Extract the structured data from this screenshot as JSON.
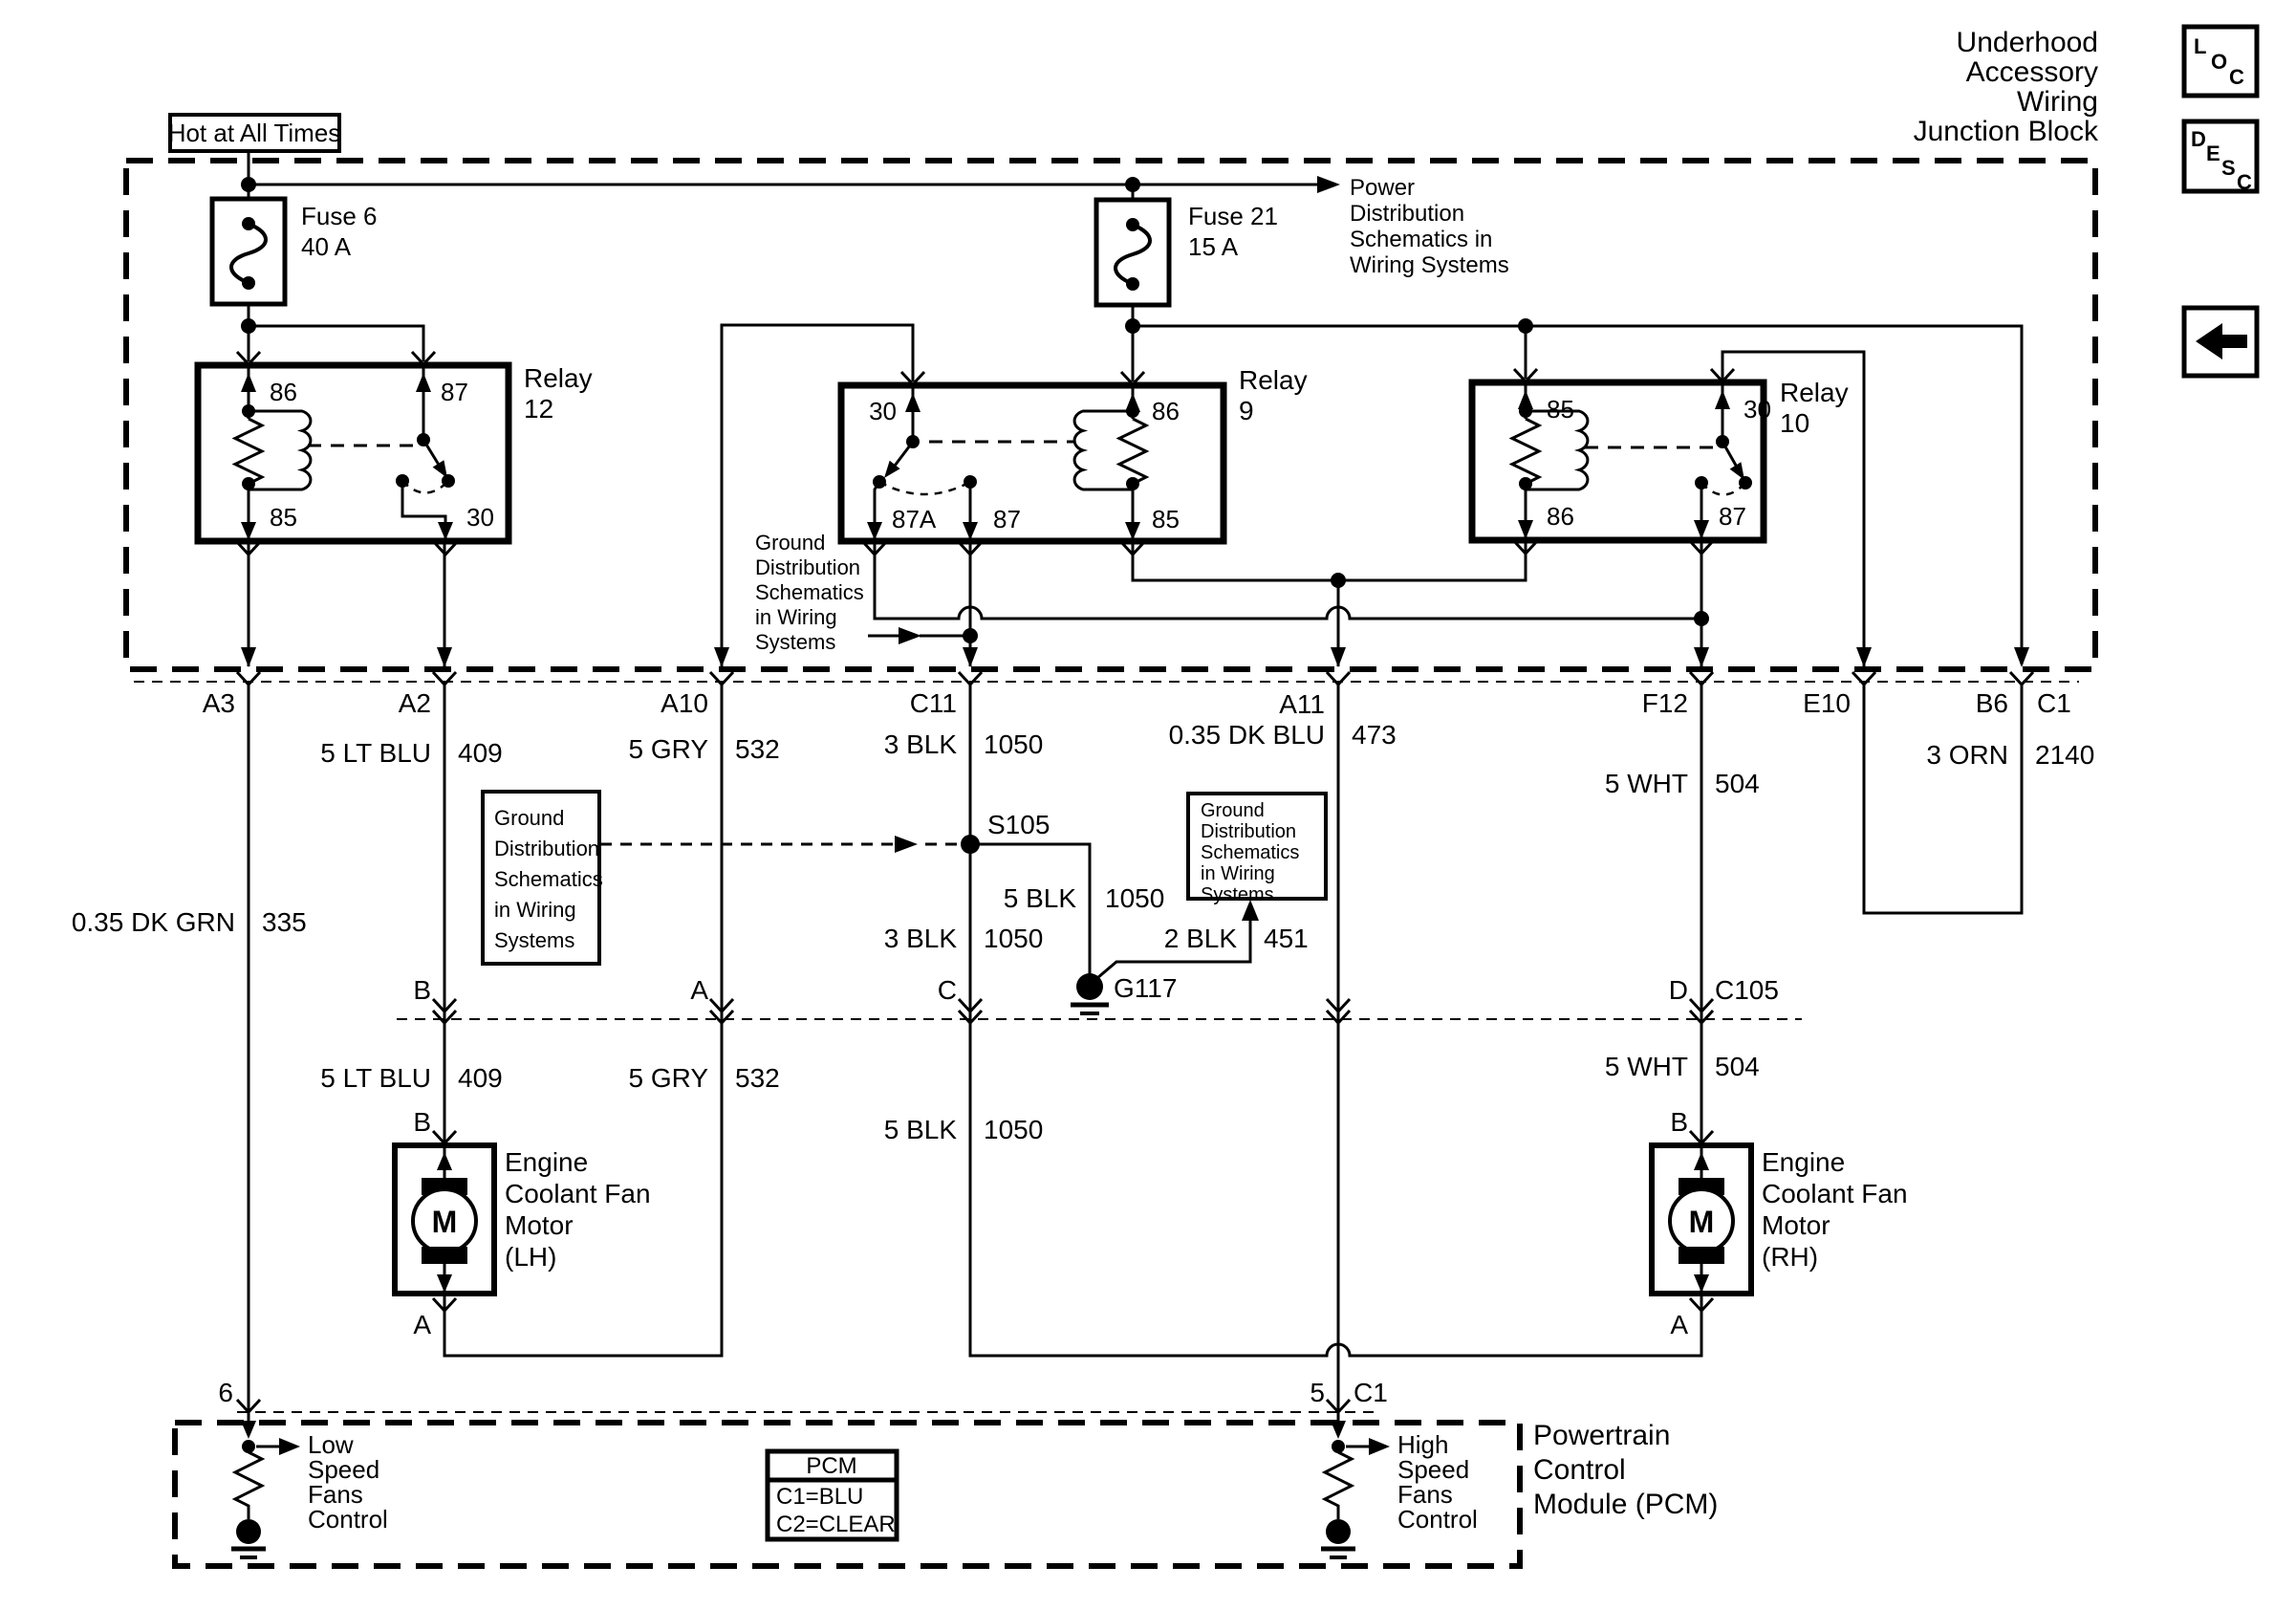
{
  "header": {
    "hot": "Hot at All Times",
    "title": [
      "Underhood",
      "Accessory",
      "Wiring",
      "Junction Block"
    ]
  },
  "icons": {
    "loc": [
      "L",
      "O",
      "C"
    ],
    "desc": [
      "D",
      "E",
      "S",
      "C"
    ]
  },
  "notes": {
    "power": [
      "Power",
      "Distribution",
      "Schematics in",
      "Wiring Systems"
    ],
    "jb_ground": [
      "Ground",
      "Distribution",
      "Schematics",
      "in Wiring",
      "Systems"
    ],
    "ground_box_left": [
      "Ground",
      "Distribution",
      "Schematics",
      "in Wiring",
      "Systems"
    ],
    "ground_box_right": [
      "Ground",
      "Distribution",
      "Schematics",
      "in Wiring",
      "Systems"
    ]
  },
  "fuse6": {
    "label": "Fuse 6",
    "rating": "40 A"
  },
  "fuse21": {
    "label": "Fuse 21",
    "rating": "15 A"
  },
  "relay12": {
    "name": "Relay",
    "num": "12",
    "p86": "86",
    "p87": "87",
    "p85": "85",
    "p30": "30"
  },
  "relay9": {
    "name": "Relay",
    "num": "9",
    "p30": "30",
    "p86": "86",
    "p87a": "87A",
    "p87": "87",
    "p85": "85"
  },
  "relay10": {
    "name": "Relay",
    "num": "10",
    "p85": "85",
    "p30": "30",
    "p86": "86",
    "p87": "87"
  },
  "row1": {
    "a3": "A3",
    "a2": "A2",
    "a10": "A10",
    "c11": "C11",
    "a11": "A11",
    "f12": "F12",
    "e10": "E10",
    "b6": "B6",
    "c1": "C1"
  },
  "wires": {
    "w409": {
      "color": "5 LT BLU",
      "id": "409"
    },
    "w532": {
      "color": "5 GRY",
      "id": "532"
    },
    "w1050_3": {
      "color": "3 BLK",
      "id": "1050"
    },
    "w473": {
      "color": "0.35 DK BLU",
      "id": "473"
    },
    "w504": {
      "color": "5 WHT",
      "id": "504"
    },
    "w2140": {
      "color": "3 ORN",
      "id": "2140"
    },
    "w335": {
      "color": "0.35 DK GRN",
      "id": "335"
    },
    "w1050_5": {
      "color": "5 BLK",
      "id": "1050"
    },
    "w451": {
      "color": "2 BLK",
      "id": "451"
    }
  },
  "splices": {
    "s105": "S105",
    "g117": "G117"
  },
  "row2": {
    "b": "B",
    "a": "A",
    "c": "C",
    "d": "D",
    "id": "C105"
  },
  "fan_lh": {
    "pin_b": "B",
    "pin_a": "A",
    "m": "M",
    "name": [
      "Engine",
      "Coolant Fan",
      "Motor",
      "(LH)"
    ]
  },
  "fan_rh": {
    "pin_b": "B",
    "pin_a": "A",
    "m": "M",
    "name": [
      "Engine",
      "Coolant Fan",
      "Motor",
      "(RH)"
    ]
  },
  "pcm": {
    "pin6": "6",
    "pin5": "5",
    "conn": "C1",
    "low": [
      "Low",
      "Speed",
      "Fans",
      "Control"
    ],
    "high": [
      "High",
      "Speed",
      "Fans",
      "Control"
    ],
    "legend": {
      "title": "PCM",
      "c1": "C1=BLU",
      "c2": "C2=CLEAR"
    },
    "name": [
      "Powertrain",
      "Control",
      "Module (PCM)"
    ]
  }
}
